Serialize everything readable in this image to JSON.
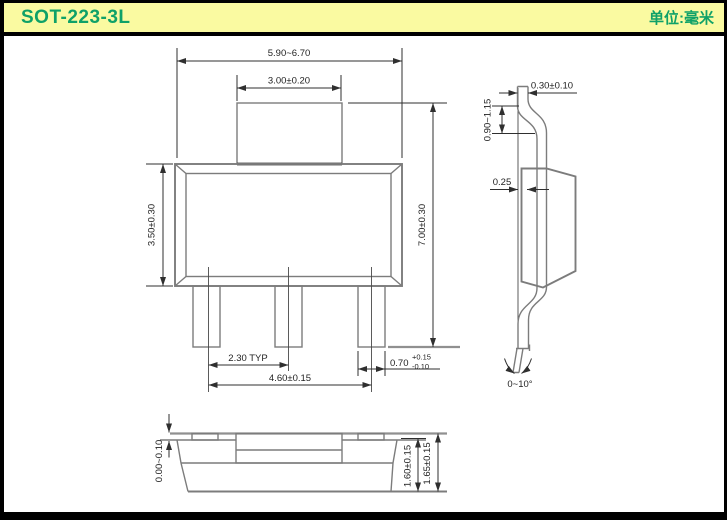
{
  "header": {
    "title": "SOT-223-3L",
    "unit_label": "单位:毫米"
  },
  "colors": {
    "header_bg": "#fafaa1",
    "accent_green": "#0fa168",
    "line_gray": "#7c7c7c",
    "dim_dark": "#2f2f2f",
    "ref_gray": "#909090",
    "frame_black": "#000000"
  },
  "views": {
    "top_view": {
      "dims": {
        "overall_width": "5.90~6.70",
        "tab_width": "3.00±0.20",
        "body_height": "3.50±0.30",
        "overall_height": "7.00±0.30",
        "lead_pitch": "2.30 TYP",
        "lead_span": "4.60±0.15",
        "lead_width_main": "0.70",
        "lead_width_tol_plus": "+0.15",
        "lead_width_tol_minus": "-0.10"
      }
    },
    "side_view": {
      "dims": {
        "lead_thickness": "0.30±0.10",
        "tab_length": "0.90~1.15",
        "foot_offset": "0.25",
        "lead_angle": "0~10°"
      }
    },
    "front_view": {
      "dims": {
        "standoff": "0.00~0.10",
        "body_thickness": "1.60±0.15",
        "overall_thickness": "1.65±0.15"
      }
    }
  }
}
